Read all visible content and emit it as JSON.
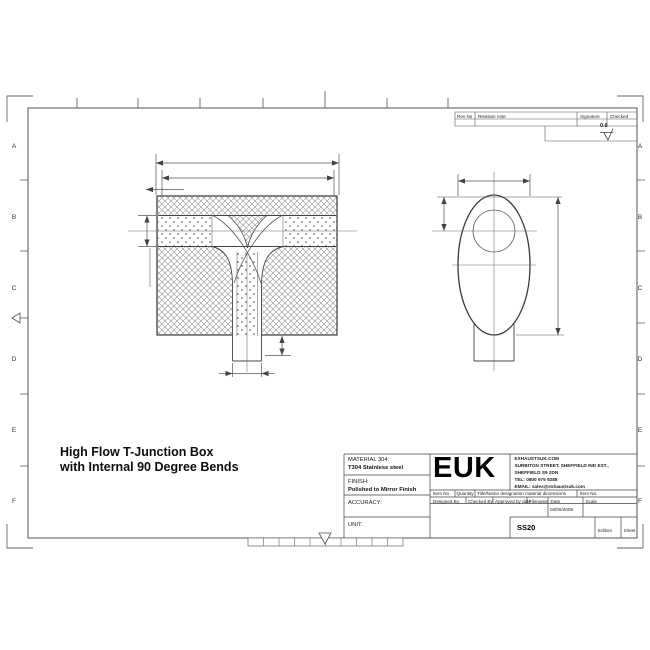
{
  "frame": {
    "row_labels": [
      "A",
      "B",
      "C",
      "D",
      "E",
      "F"
    ]
  },
  "title": {
    "line1": "High Flow T-Junction Box",
    "line2": "with Internal 90 Degree Bends"
  },
  "title_block": {
    "material_label": "MATERIAL 304:",
    "material_value": "T304 Stainless steel",
    "finish_label": "FINISH:",
    "finish_value": "Polished to Mirror Finish",
    "accuracy_label": "ACCURACY:",
    "unit_label": "UNIT:",
    "logo": "EUK",
    "company_lines": [
      "EXHAUSTSUK.COM",
      "SURBITON STREET, SHEFFIELD IND EST.,",
      "SHEFFIELD S9 2DN",
      "TEL: 0800 975 9288",
      "EMAIL: sales@exhaustsuk.com"
    ],
    "parts_header": {
      "item_no": "Item No",
      "quantity": "Quantity",
      "designation": "Title/Name designation material dimensions",
      "item_no2": "Item No."
    },
    "sign_header": {
      "designed": "Designed By.",
      "checked": "Checked By",
      "approved": "Approved by date",
      "filename": "Filename",
      "date": "Date",
      "scale": "Scale"
    },
    "date_value": "04/06/2009",
    "part_number": "SS20",
    "edition_label": "Edition",
    "sheet_label": "Sheet"
  },
  "revision_table": {
    "rev_no": "Rev No",
    "note": "Revision note",
    "signature": "Signature",
    "checked": "Checked"
  },
  "surface_finish_value": "0.6"
}
